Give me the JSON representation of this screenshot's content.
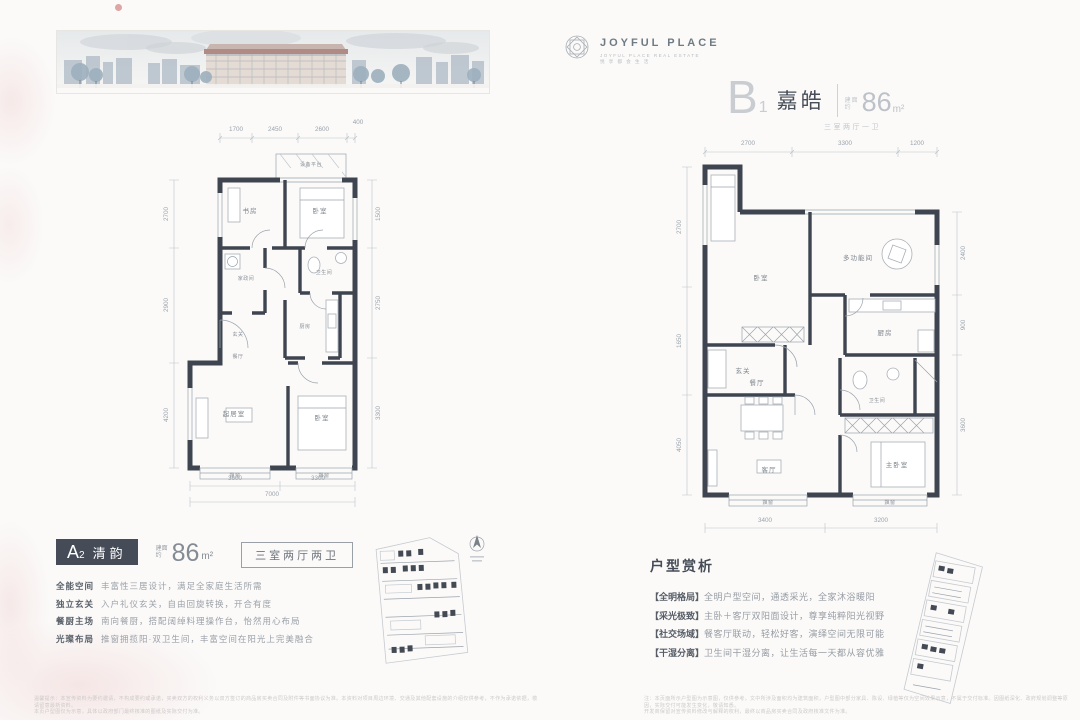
{
  "brand": {
    "name": "JOYFUL PLACE",
    "tagline1": "JOYFUL PLACE REAL ESTATE",
    "tagline2": "悦 享 都 会 生 活"
  },
  "unit_a": {
    "letter": "A",
    "sub": "2",
    "name": "清韵",
    "area_label_1": "建面",
    "area_label_2": "约",
    "area": "86",
    "area_unit": "m²",
    "layout": "三室两厅两卫",
    "features": [
      {
        "label": "全能空间",
        "text": "丰富性三居设计，满足全家庭生活所需"
      },
      {
        "label": "独立玄关",
        "text": "入户礼仪玄关，自由回旋转换，开合有度"
      },
      {
        "label": "餐厨主场",
        "text": "南向餐厨，搭配阔绰料理操作台，怡然用心布局"
      },
      {
        "label": "光璨布局",
        "text": "推窗拥揽阳·双卫生间，丰富空间在阳光上完美融合"
      }
    ],
    "plan": {
      "rooms": {
        "platform": "设备平台",
        "study": "书房",
        "bedroom2": "卧室",
        "laundry": "家政间",
        "bath": "卫生间",
        "foyer": "玄关",
        "kitchen": "厨房",
        "dining": "餐厅",
        "living": "起居室",
        "bedroom1": "卧室",
        "bay1": "飘窗",
        "bay2": "飘窗"
      },
      "dims_top": [
        "1700",
        "2450",
        "2600",
        "400"
      ],
      "dims_bottom": [
        "3600",
        "3300"
      ],
      "dim_total": "7000",
      "dims_left": [
        "2700",
        "2900",
        "4200"
      ],
      "dims_right": [
        "1500",
        "2750",
        "3300"
      ]
    }
  },
  "unit_b": {
    "letter": "B",
    "sub": "1",
    "name": "嘉皓",
    "area_label_1": "建面",
    "area_label_2": "约",
    "area": "86",
    "area_unit": "m²",
    "layout": "三室两厅一卫",
    "analysis_title": "户型赏析",
    "analysis": [
      {
        "tag": "【全明格局】",
        "text": "全明户型空间，通透采光，全家沐浴暖阳"
      },
      {
        "tag": "【采光极致】",
        "text": "主卧＋客厅双阳面设计，尊享纯粹阳光视野"
      },
      {
        "tag": "【社交场域】",
        "text": "餐客厅联动，轻松好客，演绎空间无限可能"
      },
      {
        "tag": "【干湿分离】",
        "text": "卫生间干湿分离，让生活每一天都从容优雅"
      }
    ],
    "plan": {
      "rooms": {
        "bedroom2": "卧室",
        "foyer": "玄关",
        "multi": "多功能间",
        "kitchen": "厨房",
        "bath": "卫生间",
        "dining": "餐厅",
        "living": "客厅",
        "master": "主卧室",
        "bay1": "飘窗",
        "bay2": "飘窗"
      },
      "dims_top": [
        "2700",
        "3300",
        "1200"
      ],
      "dims_bottom": [
        "3400",
        "3200"
      ],
      "dims_left": [
        "2700",
        "1650",
        "4050"
      ],
      "dims_right": [
        "2400",
        "900",
        "3600"
      ]
    }
  },
  "footnotes": {
    "left1": "温馨提示：本宣传资料为要约邀请，不构成要约或承诺，买卖双方的权利义务以双方签订的商品房买卖合同及附件等书面协议为准。本资料对项目周边环境、交通及其他配套设施的介绍仅供参考，不作为承诺依据，敬请留意最新资料。",
    "left2": "本页户型图仅为示意，具体以政府部门最终核准的图纸及实际交付为准。",
    "right1": "注：本页面所示户型图为示意图，仅供参考。文中所涉及面积均为建筑面积，户型图中部分家具、陈设、绿植等仅为空间效果示意，不属于交付标准。因图纸深化、政府规划调整等原因，实际交付可能发生变化，敬请知悉。",
    "right2": "开发商保留对宣传资料修改与解释的权利，最终以商品房买卖合同及政府核准文件为准。"
  }
}
